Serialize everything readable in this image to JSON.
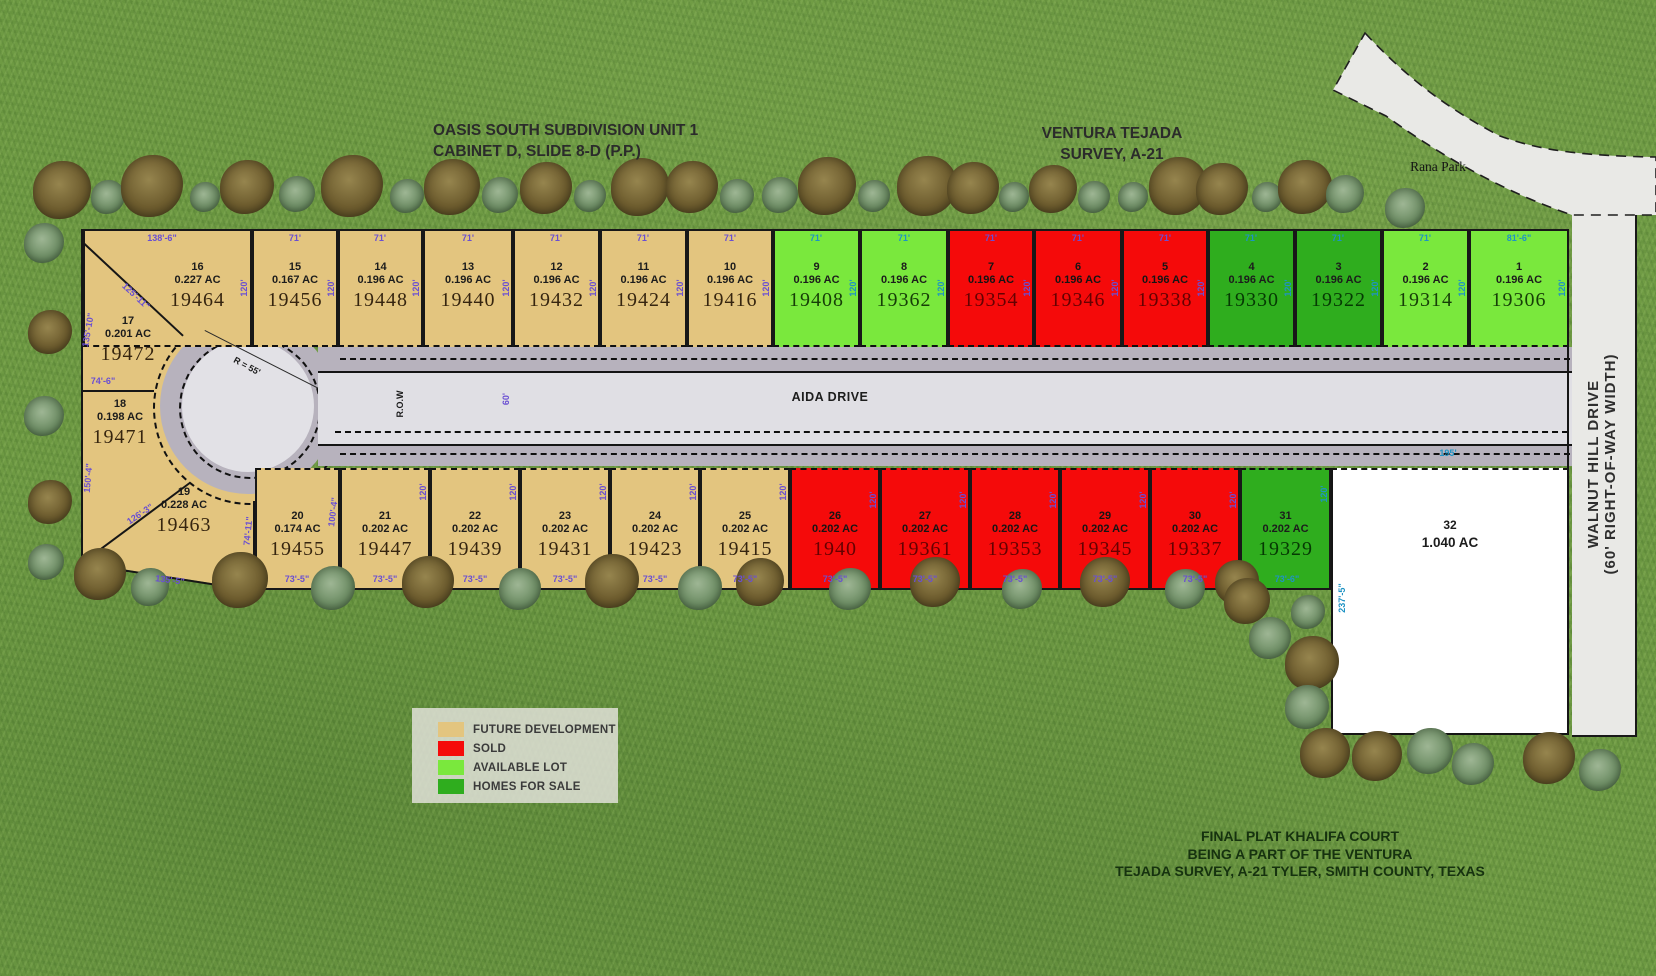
{
  "titles": {
    "subdivision": {
      "line1": "OASIS SOUTH SUBDIVISION UNIT 1",
      "line2": "CABINET D, SLIDE 8-D (P.P.)"
    },
    "survey": {
      "line1": "VENTURA TEJADA",
      "line2": "SURVEY, A-21"
    },
    "rana_park": "Rana Park",
    "walnut": {
      "line1": "WALNUT HILL DRIVE",
      "line2": "(60' RIGHT-OF-WAY WIDTH)"
    },
    "aida_drive": "AIDA DRIVE"
  },
  "footer": {
    "line1": "FINAL PLAT KHALIFA COURT",
    "line2": "BEING A PART OF THE VENTURA",
    "line3": "TEJADA SURVEY, A-21 TYLER, SMITH COUNTY, TEXAS"
  },
  "colors": {
    "future": "#e3c57f",
    "sold": "#f50a0a",
    "available": "#7ae83d",
    "forsale": "#2fad1e",
    "lot32": "#ffffff",
    "road": "#e0dfe4",
    "curb": "#b7b2bd",
    "dimPurple": "#6a4fd2",
    "dimTeal": "#1f93c4"
  },
  "legend": {
    "items": [
      {
        "label": "FUTURE DEVELOPMENT",
        "color": "#e3c57f"
      },
      {
        "label": "SOLD",
        "color": "#f50a0a"
      },
      {
        "label": "AVAILABLE LOT",
        "color": "#7ae83d"
      },
      {
        "label": "HOMES FOR SALE",
        "color": "#2fad1e"
      }
    ]
  },
  "lots": {
    "top": [
      {
        "no": "16",
        "ac": "0.227 AC",
        "id": "19464",
        "status": "future",
        "x": 83,
        "w": 169,
        "labelOffset": 60
      },
      {
        "no": "15",
        "ac": "0.167 AC",
        "id": "19456",
        "status": "future",
        "x": 252,
        "w": 86
      },
      {
        "no": "14",
        "ac": "0.196 AC",
        "id": "19448",
        "status": "future",
        "x": 338,
        "w": 85
      },
      {
        "no": "13",
        "ac": "0.196 AC",
        "id": "19440",
        "status": "future",
        "x": 423,
        "w": 90
      },
      {
        "no": "12",
        "ac": "0.196 AC",
        "id": "19432",
        "status": "future",
        "x": 513,
        "w": 87
      },
      {
        "no": "11",
        "ac": "0.196 AC",
        "id": "19424",
        "status": "future",
        "x": 600,
        "w": 87
      },
      {
        "no": "10",
        "ac": "0.196 AC",
        "id": "19416",
        "status": "future",
        "x": 687,
        "w": 86
      },
      {
        "no": "9",
        "ac": "0.196 AC",
        "id": "19408",
        "status": "available",
        "x": 773,
        "w": 87
      },
      {
        "no": "8",
        "ac": "0.196 AC",
        "id": "19362",
        "status": "available",
        "x": 860,
        "w": 88
      },
      {
        "no": "7",
        "ac": "0.196 AC",
        "id": "19354",
        "status": "sold",
        "x": 948,
        "w": 86
      },
      {
        "no": "6",
        "ac": "0.196 AC",
        "id": "19346",
        "status": "sold",
        "x": 1034,
        "w": 88
      },
      {
        "no": "5",
        "ac": "0.196 AC",
        "id": "19338",
        "status": "sold",
        "x": 1122,
        "w": 86
      },
      {
        "no": "4",
        "ac": "0.196 AC",
        "id": "19330",
        "status": "forsale",
        "x": 1208,
        "w": 87
      },
      {
        "no": "3",
        "ac": "0.196 AC",
        "id": "19322",
        "status": "forsale",
        "x": 1295,
        "w": 87
      },
      {
        "no": "2",
        "ac": "0.196 AC",
        "id": "19314",
        "status": "available",
        "x": 1382,
        "w": 87
      },
      {
        "no": "1",
        "ac": "0.196 AC",
        "id": "19306",
        "status": "available",
        "x": 1469,
        "w": 100
      }
    ],
    "bottom": [
      {
        "no": "20",
        "ac": "0.174 AC",
        "id": "19455",
        "status": "future",
        "x": 255,
        "w": 85
      },
      {
        "no": "21",
        "ac": "0.202 AC",
        "id": "19447",
        "status": "future",
        "x": 340,
        "w": 90
      },
      {
        "no": "22",
        "ac": "0.202 AC",
        "id": "19439",
        "status": "future",
        "x": 430,
        "w": 90
      },
      {
        "no": "23",
        "ac": "0.202 AC",
        "id": "19431",
        "status": "future",
        "x": 520,
        "w": 90
      },
      {
        "no": "24",
        "ac": "0.202 AC",
        "id": "19423",
        "status": "future",
        "x": 610,
        "w": 90
      },
      {
        "no": "25",
        "ac": "0.202 AC",
        "id": "19415",
        "status": "future",
        "x": 700,
        "w": 90
      },
      {
        "no": "26",
        "ac": "0.202 AC",
        "id": "1940",
        "status": "sold",
        "x": 790,
        "w": 90
      },
      {
        "no": "27",
        "ac": "0.202 AC",
        "id": "19361",
        "status": "sold",
        "x": 880,
        "w": 90
      },
      {
        "no": "28",
        "ac": "0.202 AC",
        "id": "19353",
        "status": "sold",
        "x": 970,
        "w": 90
      },
      {
        "no": "29",
        "ac": "0.202 AC",
        "id": "19345",
        "status": "sold",
        "x": 1060,
        "w": 90
      },
      {
        "no": "30",
        "ac": "0.202 AC",
        "id": "19337",
        "status": "sold",
        "x": 1150,
        "w": 90
      },
      {
        "no": "31",
        "ac": "0.202 AC",
        "id": "19329",
        "status": "forsale",
        "x": 1240,
        "w": 91
      }
    ],
    "west": [
      {
        "no": "17",
        "ac": "0.201 AC",
        "id": "19472",
        "x": 86,
        "y": 315,
        "w": 84
      },
      {
        "no": "18",
        "ac": "0.198 AC",
        "id": "19471",
        "x": 78,
        "y": 398,
        "w": 84
      },
      {
        "no": "19",
        "ac": "0.228 AC",
        "id": "19463",
        "x": 140,
        "y": 486,
        "w": 88
      }
    ],
    "lot32": {
      "no": "32",
      "ac": "1.040 AC"
    }
  },
  "dims": [
    {
      "t": "138'-6\"",
      "x": 162,
      "y": 238,
      "r": 0,
      "c": "p"
    },
    {
      "t": "71'",
      "x": 295,
      "y": 238,
      "r": 0,
      "c": "p"
    },
    {
      "t": "71'",
      "x": 380,
      "y": 238,
      "r": 0,
      "c": "p"
    },
    {
      "t": "71'",
      "x": 468,
      "y": 238,
      "r": 0,
      "c": "p"
    },
    {
      "t": "71'",
      "x": 556,
      "y": 238,
      "r": 0,
      "c": "p"
    },
    {
      "t": "71'",
      "x": 643,
      "y": 238,
      "r": 0,
      "c": "p"
    },
    {
      "t": "71'",
      "x": 730,
      "y": 238,
      "r": 0,
      "c": "p"
    },
    {
      "t": "71'",
      "x": 816,
      "y": 238,
      "r": 0,
      "c": "b"
    },
    {
      "t": "71'",
      "x": 904,
      "y": 238,
      "r": 0,
      "c": "b"
    },
    {
      "t": "71'",
      "x": 991,
      "y": 238,
      "r": 0,
      "c": "p"
    },
    {
      "t": "71'",
      "x": 1078,
      "y": 238,
      "r": 0,
      "c": "p"
    },
    {
      "t": "71'",
      "x": 1165,
      "y": 238,
      "r": 0,
      "c": "p"
    },
    {
      "t": "71'",
      "x": 1251,
      "y": 238,
      "r": 0,
      "c": "b"
    },
    {
      "t": "71'",
      "x": 1338,
      "y": 238,
      "r": 0,
      "c": "b"
    },
    {
      "t": "71'",
      "x": 1425,
      "y": 238,
      "r": 0,
      "c": "b"
    },
    {
      "t": "81'-6\"",
      "x": 1519,
      "y": 238,
      "r": 0,
      "c": "b"
    },
    {
      "t": "120'",
      "x": 244,
      "y": 288,
      "r": -90,
      "c": "p"
    },
    {
      "t": "120'",
      "x": 331,
      "y": 288,
      "r": -90,
      "c": "p"
    },
    {
      "t": "120'",
      "x": 416,
      "y": 288,
      "r": -90,
      "c": "p"
    },
    {
      "t": "120'",
      "x": 506,
      "y": 288,
      "r": -90,
      "c": "p"
    },
    {
      "t": "120'",
      "x": 593,
      "y": 288,
      "r": -90,
      "c": "p"
    },
    {
      "t": "120'",
      "x": 680,
      "y": 288,
      "r": -90,
      "c": "p"
    },
    {
      "t": "120'",
      "x": 766,
      "y": 288,
      "r": -90,
      "c": "p"
    },
    {
      "t": "120'",
      "x": 853,
      "y": 288,
      "r": -90,
      "c": "b"
    },
    {
      "t": "120'",
      "x": 941,
      "y": 288,
      "r": -90,
      "c": "b"
    },
    {
      "t": "120'",
      "x": 1027,
      "y": 288,
      "r": -90,
      "c": "p"
    },
    {
      "t": "120'",
      "x": 1115,
      "y": 288,
      "r": -90,
      "c": "p"
    },
    {
      "t": "120'",
      "x": 1201,
      "y": 288,
      "r": -90,
      "c": "p"
    },
    {
      "t": "120'",
      "x": 1288,
      "y": 288,
      "r": -90,
      "c": "b"
    },
    {
      "t": "120'",
      "x": 1375,
      "y": 288,
      "r": -90,
      "c": "b"
    },
    {
      "t": "120'",
      "x": 1462,
      "y": 288,
      "r": -90,
      "c": "b"
    },
    {
      "t": "120'",
      "x": 1562,
      "y": 288,
      "r": -90,
      "c": "b"
    },
    {
      "t": "73'-5\"",
      "x": 297,
      "y": 579,
      "r": 0,
      "c": "p"
    },
    {
      "t": "73'-5\"",
      "x": 385,
      "y": 579,
      "r": 0,
      "c": "p"
    },
    {
      "t": "73'-5\"",
      "x": 475,
      "y": 579,
      "r": 0,
      "c": "p"
    },
    {
      "t": "73'-5\"",
      "x": 565,
      "y": 579,
      "r": 0,
      "c": "p"
    },
    {
      "t": "73'-5\"",
      "x": 655,
      "y": 579,
      "r": 0,
      "c": "p"
    },
    {
      "t": "73'-5\"",
      "x": 745,
      "y": 579,
      "r": 0,
      "c": "p"
    },
    {
      "t": "73'-5\"",
      "x": 835,
      "y": 579,
      "r": 0,
      "c": "p"
    },
    {
      "t": "73'-5\"",
      "x": 925,
      "y": 579,
      "r": 0,
      "c": "p"
    },
    {
      "t": "73'-5\"",
      "x": 1015,
      "y": 579,
      "r": 0,
      "c": "p"
    },
    {
      "t": "73'-5\"",
      "x": 1105,
      "y": 579,
      "r": 0,
      "c": "p"
    },
    {
      "t": "73'-5\"",
      "x": 1195,
      "y": 579,
      "r": 0,
      "c": "p"
    },
    {
      "t": "73'-6\"",
      "x": 1287,
      "y": 579,
      "r": 0,
      "c": "b"
    },
    {
      "t": "135'-5\"",
      "x": 170,
      "y": 580,
      "r": 7,
      "c": "p"
    },
    {
      "t": "100'-4\"",
      "x": 333,
      "y": 512,
      "r": -83,
      "c": "p"
    },
    {
      "t": "120'",
      "x": 423,
      "y": 492,
      "r": -90,
      "c": "p"
    },
    {
      "t": "120'",
      "x": 513,
      "y": 492,
      "r": -90,
      "c": "p"
    },
    {
      "t": "120'",
      "x": 603,
      "y": 492,
      "r": -90,
      "c": "p"
    },
    {
      "t": "120'",
      "x": 693,
      "y": 492,
      "r": -90,
      "c": "p"
    },
    {
      "t": "120'",
      "x": 783,
      "y": 492,
      "r": -90,
      "c": "p"
    },
    {
      "t": "120'",
      "x": 873,
      "y": 500,
      "r": -90,
      "c": "p"
    },
    {
      "t": "120'",
      "x": 963,
      "y": 500,
      "r": -90,
      "c": "p"
    },
    {
      "t": "120'",
      "x": 1053,
      "y": 500,
      "r": -90,
      "c": "p"
    },
    {
      "t": "120'",
      "x": 1143,
      "y": 500,
      "r": -90,
      "c": "p"
    },
    {
      "t": "120'",
      "x": 1233,
      "y": 500,
      "r": -90,
      "c": "p"
    },
    {
      "t": "120'",
      "x": 1324,
      "y": 494,
      "r": -90,
      "c": "b"
    },
    {
      "t": "195'",
      "x": 1448,
      "y": 453,
      "r": 0,
      "c": "b"
    },
    {
      "t": "237'-5\"",
      "x": 1342,
      "y": 598,
      "r": -90,
      "c": "b"
    },
    {
      "t": "74'-6\"",
      "x": 103,
      "y": 381,
      "r": 0,
      "c": "p"
    },
    {
      "t": "135'-10\"",
      "x": 88,
      "y": 330,
      "r": -80,
      "c": "p"
    },
    {
      "t": "125'-11\"",
      "x": 136,
      "y": 296,
      "r": 43,
      "c": "p"
    },
    {
      "t": "150'-4\"",
      "x": 88,
      "y": 478,
      "r": -85,
      "c": "p"
    },
    {
      "t": "126'-3\"",
      "x": 140,
      "y": 514,
      "r": -34,
      "c": "p"
    },
    {
      "t": "74'-11\"",
      "x": 248,
      "y": 531,
      "r": -84,
      "c": "p"
    },
    {
      "t": "R = 55'",
      "x": 247,
      "y": 366,
      "r": 28,
      "c": "k"
    },
    {
      "t": "R.O.W",
      "x": 400,
      "y": 404,
      "r": -90,
      "c": "k"
    },
    {
      "t": "60'",
      "x": 506,
      "y": 399,
      "r": -90,
      "c": "p"
    }
  ]
}
